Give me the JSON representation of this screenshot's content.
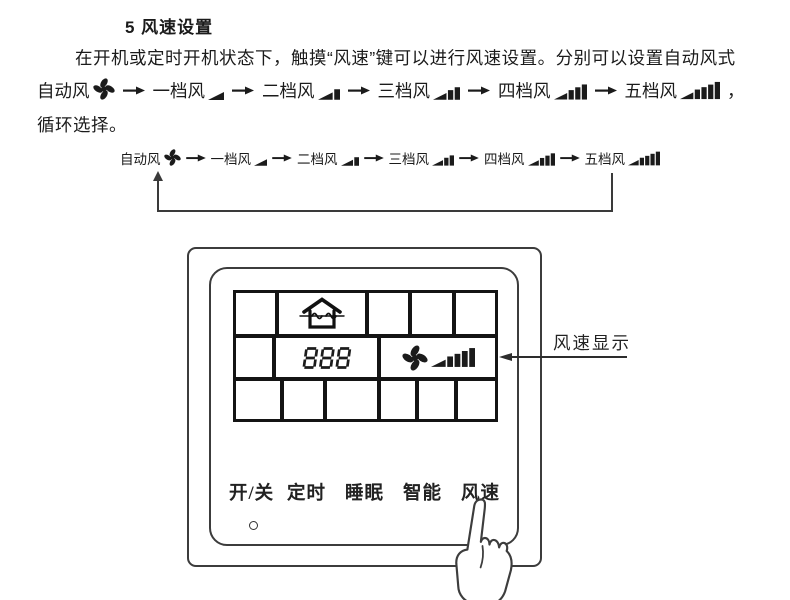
{
  "heading": "5 风速设置",
  "intro": {
    "line1": "在开机或定时开机状态下，触摸“风速”键可以进行风速设置。分别可以设置自动风式",
    "trailing_comma": "，",
    "line2": "循环选择。"
  },
  "speed_flow": {
    "items": [
      {
        "label": "自动风",
        "icon": "fan-icon",
        "bars": 0
      },
      {
        "label": "一档风",
        "icon": "speed-bars-1-icon",
        "bars": 1
      },
      {
        "label": "二档风",
        "icon": "speed-bars-2-icon",
        "bars": 2
      },
      {
        "label": "三档风",
        "icon": "speed-bars-3-icon",
        "bars": 3
      },
      {
        "label": "四档风",
        "icon": "speed-bars-4-icon",
        "bars": 4
      },
      {
        "label": "五档风",
        "icon": "speed-bars-5-icon",
        "bars": 5
      }
    ],
    "cycle": true
  },
  "panel": {
    "lcd": {
      "digits": "888",
      "icons": [
        "house-airflow-icon",
        "fan-icon",
        "speed-bars-5-icon"
      ],
      "rows": [
        5,
        3,
        6
      ]
    },
    "buttons": [
      {
        "label": "开/关"
      },
      {
        "label": "定时"
      },
      {
        "label": "睡眠"
      },
      {
        "label": "智能"
      },
      {
        "label": "风速",
        "pointed_by_hand": true
      }
    ],
    "led": true
  },
  "callout": {
    "label": "风速显示"
  },
  "colors": {
    "ink": "#1b1b1b",
    "line": "#3a3a3a",
    "background": "#ffffff"
  }
}
